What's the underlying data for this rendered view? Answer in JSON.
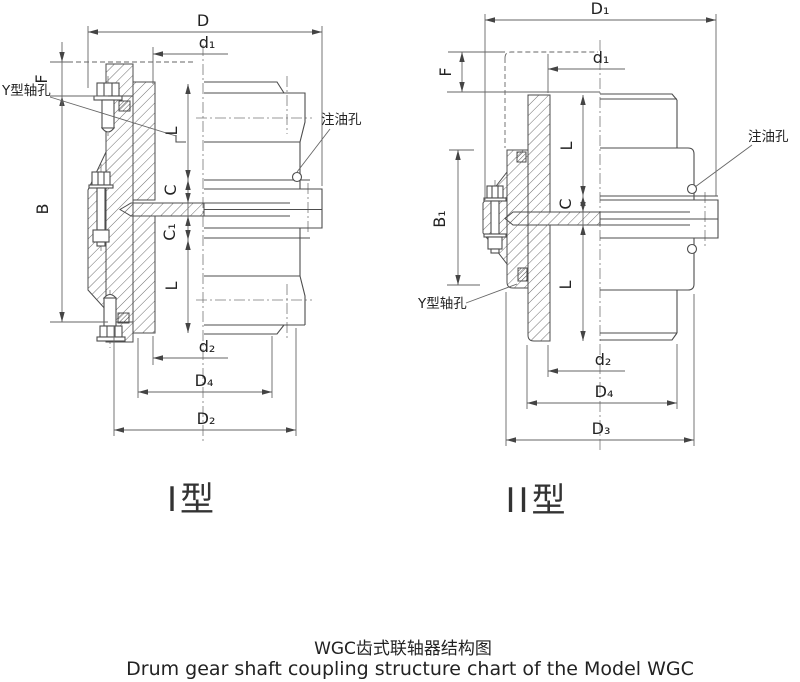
{
  "page": {
    "background": "#ffffff",
    "line_color": "#4d4d4d",
    "text_color": "#222222"
  },
  "drawings": {
    "type1": {
      "caption": "I型",
      "dims": {
        "D": "D",
        "d1": "d₁",
        "F": "F",
        "B": "B",
        "L_top": "L",
        "C": "C",
        "C1": "C₁",
        "L_bot": "L",
        "d2": "d₂",
        "D4": "D₄",
        "D2": "D₂"
      },
      "callouts": {
        "shaft_hole": "Y型轴孔",
        "oil_hole": "注油孔"
      }
    },
    "type2": {
      "caption": "II型",
      "dims": {
        "D1": "D₁",
        "d1": "d₁",
        "F": "F",
        "B1": "B₁",
        "L_top": "L",
        "C": "C",
        "L_bot": "L",
        "d2": "d₂",
        "D4": "D₄",
        "D3": "D₃"
      },
      "callouts": {
        "shaft_hole": "Y型轴孔",
        "oil_hole": "注油孔"
      }
    }
  },
  "footer": {
    "title_zh": "WGC齿式联轴器结构图",
    "title_en": "Drum gear shaft coupling structure chart of the Model WGC"
  }
}
